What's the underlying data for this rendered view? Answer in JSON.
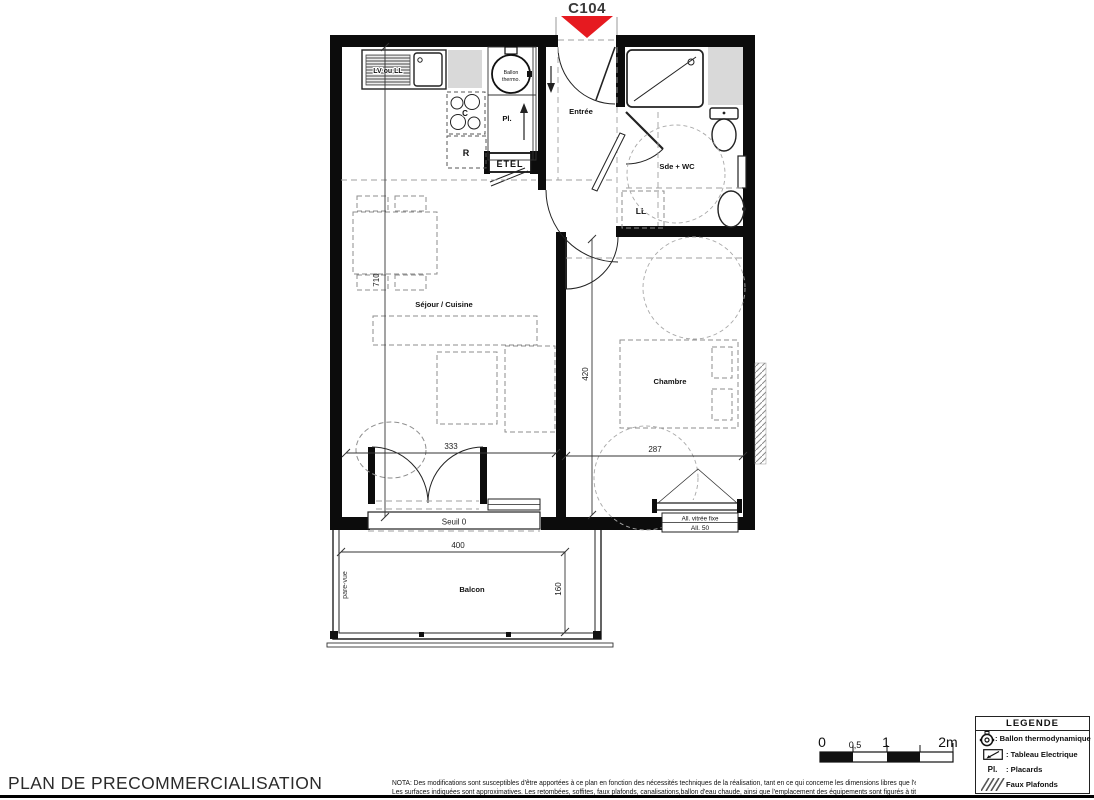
{
  "unit": {
    "label": "C104"
  },
  "rooms": {
    "entree": "Entrée",
    "sde_wc": "Sde + WC",
    "sejour": "Séjour / Cuisine",
    "chambre": "Chambre",
    "balcon": "Balcon"
  },
  "fixtures": {
    "lv_ll": "LV ou LL",
    "ballon_line1": "Ballon",
    "ballon_line2": "thermo.",
    "pl": "Pl.",
    "hob": "C",
    "fridge": "R",
    "etel": "ETEL",
    "ll": "LL"
  },
  "marks": {
    "seuil": "Seuil 0",
    "all_vitree": "All. vitrée fixe",
    "all_50": "All. 50",
    "pare_vue": "pare-vue"
  },
  "dims": {
    "sejour_h": "710",
    "sejour_w": "333",
    "chambre_h": "420",
    "chambre_w": "287",
    "balcon_w": "400",
    "balcon_d": "160"
  },
  "scale_bar": {
    "t0": "0",
    "t05": "0,5",
    "t1": "1",
    "t2": "2m"
  },
  "legend": {
    "title": "LEGENDE",
    "items": [
      {
        "icon": "ballon-thermodynamique-icon",
        "label": ": Ballon thermodynamique"
      },
      {
        "icon": "tableau-electrique-icon",
        "label": ": Tableau Electrique"
      },
      {
        "icon_text": "Pl.",
        "label": ": Placards"
      },
      {
        "icon": "faux-plafonds-hatch-icon",
        "label": "Faux Plafonds"
      }
    ]
  },
  "footer": {
    "title": "PLAN DE PRECOMMERCIALISATION",
    "nota_line1": "NOTA:  Des modifications sont susceptibles d'être apportées à ce plan en fonction des nécessités techniques de la réalisation, tant en ce qui concerne les dimensions libres que l'équipement.",
    "nota_line2": "Les surfaces indiquées sont approximatives. Les retombées, soffites, faux plafonds, canalisations,ballon d'eau chaude, ainsi que l'emplacement des équipements sont figurés à titre indicatif"
  },
  "colors": {
    "arrow_red": "#e61a20",
    "wall": "#0c0c0c",
    "shaft_gray": "#d9d9d9"
  }
}
